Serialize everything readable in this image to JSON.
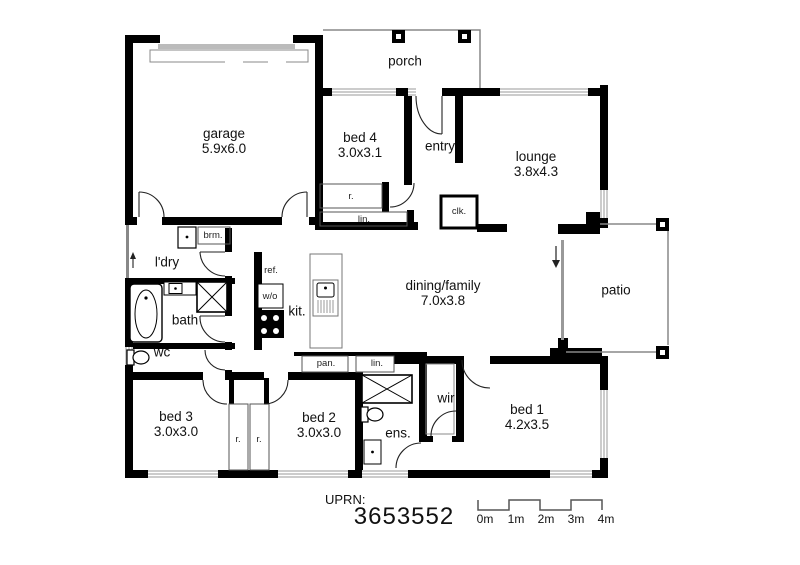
{
  "rooms": {
    "garage": {
      "name": "garage",
      "dims": "5.9x6.0"
    },
    "porch": {
      "name": "porch",
      "dims": ""
    },
    "bed4": {
      "name": "bed 4",
      "dims": "3.0x3.1"
    },
    "entry": {
      "name": "entry",
      "dims": ""
    },
    "lounge": {
      "name": "lounge",
      "dims": "3.8x4.3"
    },
    "ldry": {
      "name": "l'dry",
      "dims": ""
    },
    "bath": {
      "name": "bath",
      "dims": ""
    },
    "wc": {
      "name": "wc",
      "dims": ""
    },
    "kitchen": {
      "name": "kit.",
      "dims": ""
    },
    "dining": {
      "name": "dining/family",
      "dims": "7.0x3.8"
    },
    "patio": {
      "name": "patio",
      "dims": ""
    },
    "bed3": {
      "name": "bed 3",
      "dims": "3.0x3.0"
    },
    "bed2": {
      "name": "bed 2",
      "dims": "3.0x3.0"
    },
    "ens": {
      "name": "ens.",
      "dims": ""
    },
    "wir": {
      "name": "wir",
      "dims": ""
    },
    "bed1": {
      "name": "bed 1",
      "dims": "4.2x3.5"
    }
  },
  "closets": {
    "broom": "brm.",
    "robe_bed4": "r.",
    "linen_bed4": "lin.",
    "cloak": "clk.",
    "fridge": "ref.",
    "wall_oven": "w/o",
    "pantry": "pan.",
    "linen_hall": "lin.",
    "robe_bed3": "r.",
    "robe_bed2": "r."
  },
  "footer": {
    "uprn_label": "UPRN:",
    "uprn_value": "3653552",
    "scale_ticks": [
      "0m",
      "1m",
      "2m",
      "3m",
      "4m"
    ]
  },
  "colors": {
    "wall": "#000000",
    "window": "#999999",
    "thin_line": "#888888",
    "text": "#111111"
  }
}
